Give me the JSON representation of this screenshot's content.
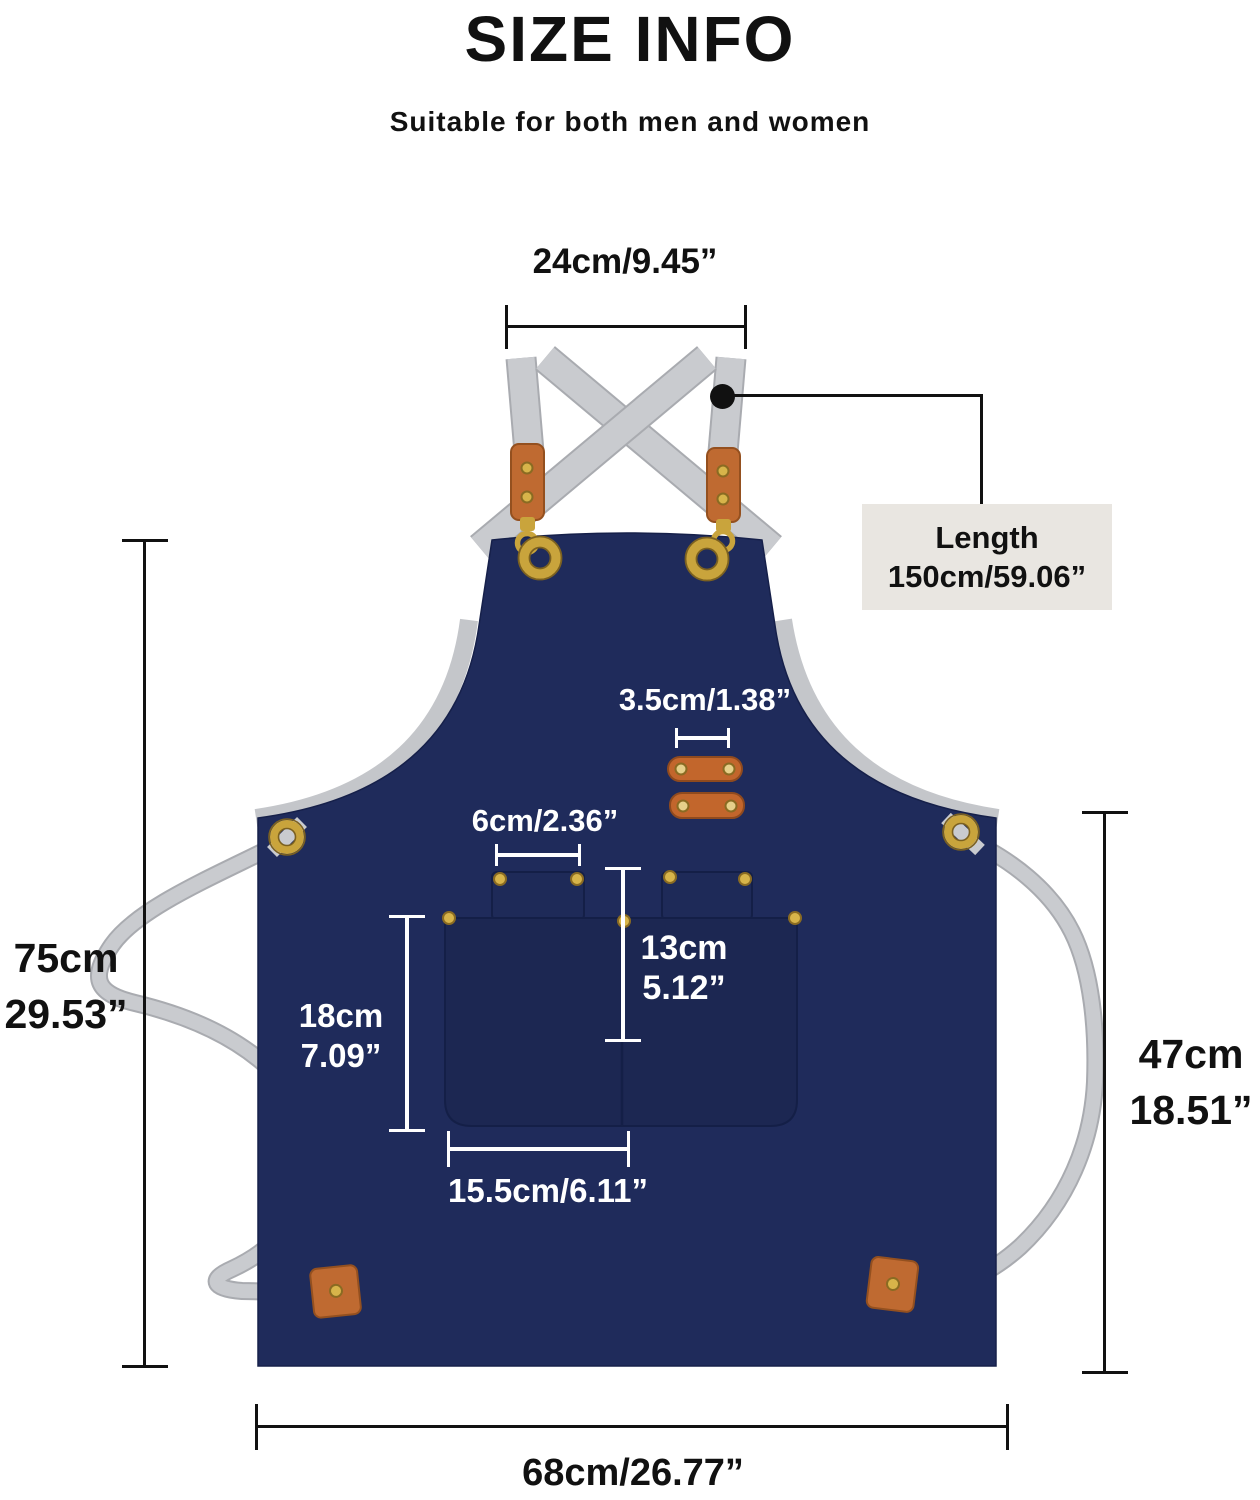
{
  "header": {
    "title": "SIZE INFO",
    "subtitle": "Suitable for both men and women"
  },
  "dims": {
    "top_strap_width": "24cm/9.45”",
    "strap_length": {
      "label": "Length",
      "value": "150cm/59.06”"
    },
    "loop_width": "3.5cm/1.38”",
    "flap_width": "6cm/2.36”",
    "total_height": {
      "cm": "75cm",
      "inch": "29.53”"
    },
    "pocket_height": {
      "cm": "18cm",
      "inch": "7.09”"
    },
    "pocket_depth": {
      "cm": "13cm",
      "inch": "5.12”"
    },
    "lower_height": {
      "cm": "47cm",
      "inch": "18.51”"
    },
    "pocket_width": "15.5cm/6.11”",
    "bottom_width": "68cm/26.77”"
  },
  "colors": {
    "apron_navy": "#1f2b5b",
    "pocket_navy": "#1c2752",
    "strap_gray": "#c9cbcf",
    "leather_brown": "#bf6a31",
    "gold": "#c9a43c",
    "length_box_bg": "#e9e6e1",
    "annotation_black": "#111111",
    "annotation_white": "#ffffff"
  }
}
